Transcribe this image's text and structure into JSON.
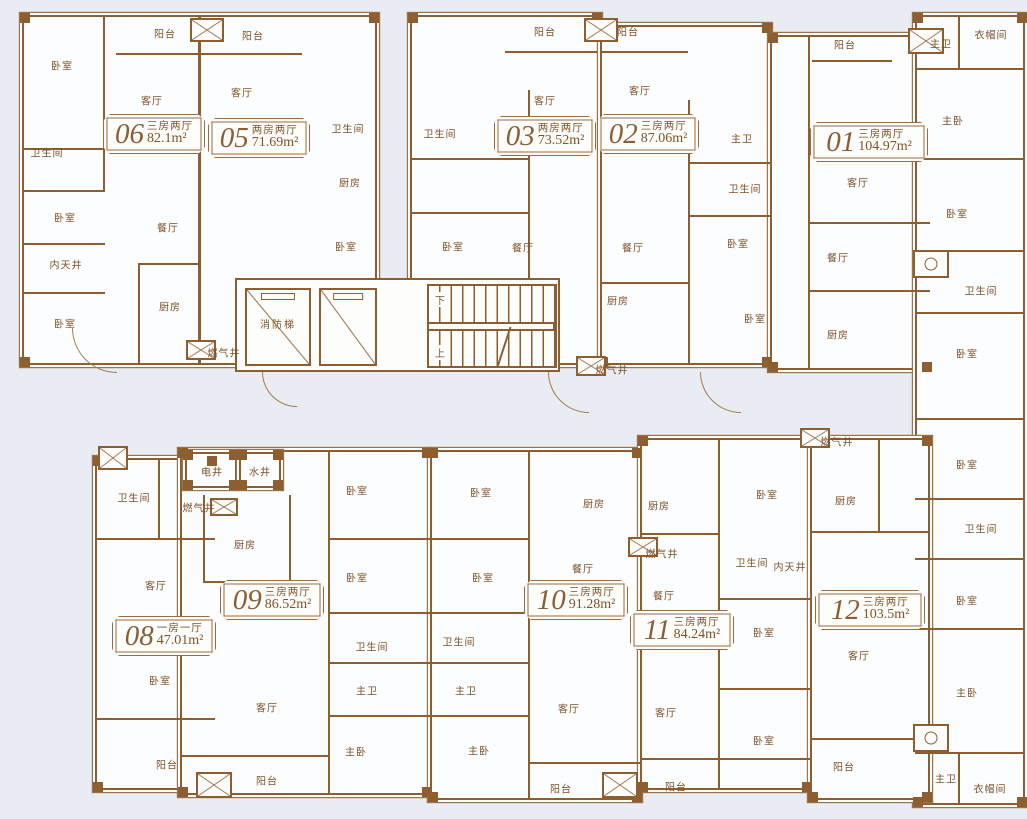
{
  "colors": {
    "background": "#e9edf3",
    "wall": "#8d5f30",
    "room_fill": "#fcfdfe",
    "label_text": "#7b5228",
    "badge_border": "#9a6c3e"
  },
  "core": {
    "fire_elevator": "消防梯",
    "stairs_down": "下",
    "stairs_up": "上"
  },
  "units": [
    {
      "id": "06",
      "layout": "三房两厅",
      "area": "82.1m²",
      "x": 103,
      "y": 114,
      "w": 102
    },
    {
      "id": "05",
      "layout": "两房两厅",
      "area": "71.69m²",
      "x": 208,
      "y": 118,
      "w": 102
    },
    {
      "id": "03",
      "layout": "两房两厅",
      "area": "73.52m²",
      "x": 494,
      "y": 116,
      "w": 102
    },
    {
      "id": "02",
      "layout": "三房两厅",
      "area": "87.06m²",
      "x": 597,
      "y": 114,
      "w": 102
    },
    {
      "id": "01",
      "layout": "三房两厅",
      "area": "104.97m²",
      "x": 810,
      "y": 122,
      "w": 118
    },
    {
      "id": "08",
      "layout": "一房一厅",
      "area": "47.01m²",
      "x": 112,
      "y": 616,
      "w": 104
    },
    {
      "id": "09",
      "layout": "三房两厅",
      "area": "86.52m²",
      "x": 220,
      "y": 580,
      "w": 104
    },
    {
      "id": "10",
      "layout": "三房两厅",
      "area": "91.28m²",
      "x": 524,
      "y": 580,
      "w": 104
    },
    {
      "id": "11",
      "layout": "三房两厅",
      "area": "84.24m²",
      "x": 630,
      "y": 610,
      "w": 104
    },
    {
      "id": "12",
      "layout": "三房两厅",
      "area": "103.5m²",
      "x": 815,
      "y": 590,
      "w": 110
    }
  ],
  "rooms": [
    {
      "t": "阳台",
      "x": 165,
      "y": 33
    },
    {
      "t": "阳台",
      "x": 253,
      "y": 35
    },
    {
      "t": "阳台",
      "x": 545,
      "y": 31
    },
    {
      "t": "阳台",
      "x": 628,
      "y": 31
    },
    {
      "t": "阳台",
      "x": 845,
      "y": 44
    },
    {
      "t": "卧室",
      "x": 62,
      "y": 65
    },
    {
      "t": "客厅",
      "x": 152,
      "y": 100
    },
    {
      "t": "客厅",
      "x": 242,
      "y": 92
    },
    {
      "t": "卫生间",
      "x": 47,
      "y": 152
    },
    {
      "t": "卧室",
      "x": 65,
      "y": 217
    },
    {
      "t": "内天井",
      "x": 66,
      "y": 264
    },
    {
      "t": "卧室",
      "x": 65,
      "y": 323
    },
    {
      "t": "餐厅",
      "x": 168,
      "y": 227
    },
    {
      "t": "厨房",
      "x": 170,
      "y": 306
    },
    {
      "t": "燃气井",
      "x": 224,
      "y": 352
    },
    {
      "t": "卫生间",
      "x": 348,
      "y": 128
    },
    {
      "t": "厨房",
      "x": 350,
      "y": 182
    },
    {
      "t": "卧室",
      "x": 346,
      "y": 246
    },
    {
      "t": "客厅",
      "x": 545,
      "y": 100
    },
    {
      "t": "卫生间",
      "x": 440,
      "y": 133
    },
    {
      "t": "卧室",
      "x": 453,
      "y": 246
    },
    {
      "t": "餐厅",
      "x": 523,
      "y": 247
    },
    {
      "t": "厨房",
      "x": 618,
      "y": 300
    },
    {
      "t": "燃气井",
      "x": 612,
      "y": 369
    },
    {
      "t": "客厅",
      "x": 640,
      "y": 90
    },
    {
      "t": "餐厅",
      "x": 633,
      "y": 247
    },
    {
      "t": "主卫",
      "x": 742,
      "y": 138
    },
    {
      "t": "卫生间",
      "x": 745,
      "y": 188
    },
    {
      "t": "卧室",
      "x": 738,
      "y": 243
    },
    {
      "t": "卧室",
      "x": 755,
      "y": 318
    },
    {
      "t": "客厅",
      "x": 858,
      "y": 182
    },
    {
      "t": "餐厅",
      "x": 838,
      "y": 257
    },
    {
      "t": "厨房",
      "x": 838,
      "y": 334
    },
    {
      "t": "主卫",
      "x": 941,
      "y": 43
    },
    {
      "t": "衣帽间",
      "x": 991,
      "y": 34
    },
    {
      "t": "主卧",
      "x": 953,
      "y": 120
    },
    {
      "t": "卧室",
      "x": 957,
      "y": 213
    },
    {
      "t": "卫生间",
      "x": 981,
      "y": 290
    },
    {
      "t": "卧室",
      "x": 967,
      "y": 353
    },
    {
      "t": "卧室",
      "x": 967,
      "y": 464
    },
    {
      "t": "卫生间",
      "x": 981,
      "y": 528
    },
    {
      "t": "卧室",
      "x": 967,
      "y": 600
    },
    {
      "t": "燃气井",
      "x": 837,
      "y": 441
    },
    {
      "t": "主卧",
      "x": 967,
      "y": 692
    },
    {
      "t": "主卫",
      "x": 946,
      "y": 778
    },
    {
      "t": "衣帽间",
      "x": 990,
      "y": 788
    },
    {
      "t": "卫生间",
      "x": 134,
      "y": 497
    },
    {
      "t": "客厅",
      "x": 156,
      "y": 585
    },
    {
      "t": "卧室",
      "x": 160,
      "y": 680
    },
    {
      "t": "阳台",
      "x": 167,
      "y": 764
    },
    {
      "t": "电井",
      "x": 212,
      "y": 471
    },
    {
      "t": "水井",
      "x": 260,
      "y": 471
    },
    {
      "t": "燃气井",
      "x": 199,
      "y": 507
    },
    {
      "t": "厨房",
      "x": 245,
      "y": 544
    },
    {
      "t": "卧室",
      "x": 357,
      "y": 490
    },
    {
      "t": "卧室",
      "x": 357,
      "y": 577
    },
    {
      "t": "卫生间",
      "x": 372,
      "y": 646
    },
    {
      "t": "主卫",
      "x": 367,
      "y": 690
    },
    {
      "t": "客厅",
      "x": 267,
      "y": 707
    },
    {
      "t": "主卧",
      "x": 356,
      "y": 751
    },
    {
      "t": "阳台",
      "x": 267,
      "y": 780
    },
    {
      "t": "卧室",
      "x": 481,
      "y": 492
    },
    {
      "t": "卧室",
      "x": 483,
      "y": 577
    },
    {
      "t": "卫生间",
      "x": 459,
      "y": 641
    },
    {
      "t": "主卫",
      "x": 466,
      "y": 690
    },
    {
      "t": "客厅",
      "x": 569,
      "y": 708
    },
    {
      "t": "主卧",
      "x": 479,
      "y": 750
    },
    {
      "t": "阳台",
      "x": 561,
      "y": 788
    },
    {
      "t": "厨房",
      "x": 594,
      "y": 503
    },
    {
      "t": "餐厅",
      "x": 583,
      "y": 568
    },
    {
      "t": "厨房",
      "x": 659,
      "y": 505
    },
    {
      "t": "燃气井",
      "x": 662,
      "y": 553
    },
    {
      "t": "餐厅",
      "x": 664,
      "y": 595
    },
    {
      "t": "卧室",
      "x": 767,
      "y": 494
    },
    {
      "t": "厨房",
      "x": 846,
      "y": 500
    },
    {
      "t": "卫生间",
      "x": 752,
      "y": 562
    },
    {
      "t": "内天井",
      "x": 790,
      "y": 566
    },
    {
      "t": "卧室",
      "x": 764,
      "y": 632
    },
    {
      "t": "客厅",
      "x": 666,
      "y": 712
    },
    {
      "t": "卧室",
      "x": 764,
      "y": 740
    },
    {
      "t": "阳台",
      "x": 676,
      "y": 786
    },
    {
      "t": "客厅",
      "x": 859,
      "y": 655
    },
    {
      "t": "阳台",
      "x": 844,
      "y": 766
    }
  ]
}
